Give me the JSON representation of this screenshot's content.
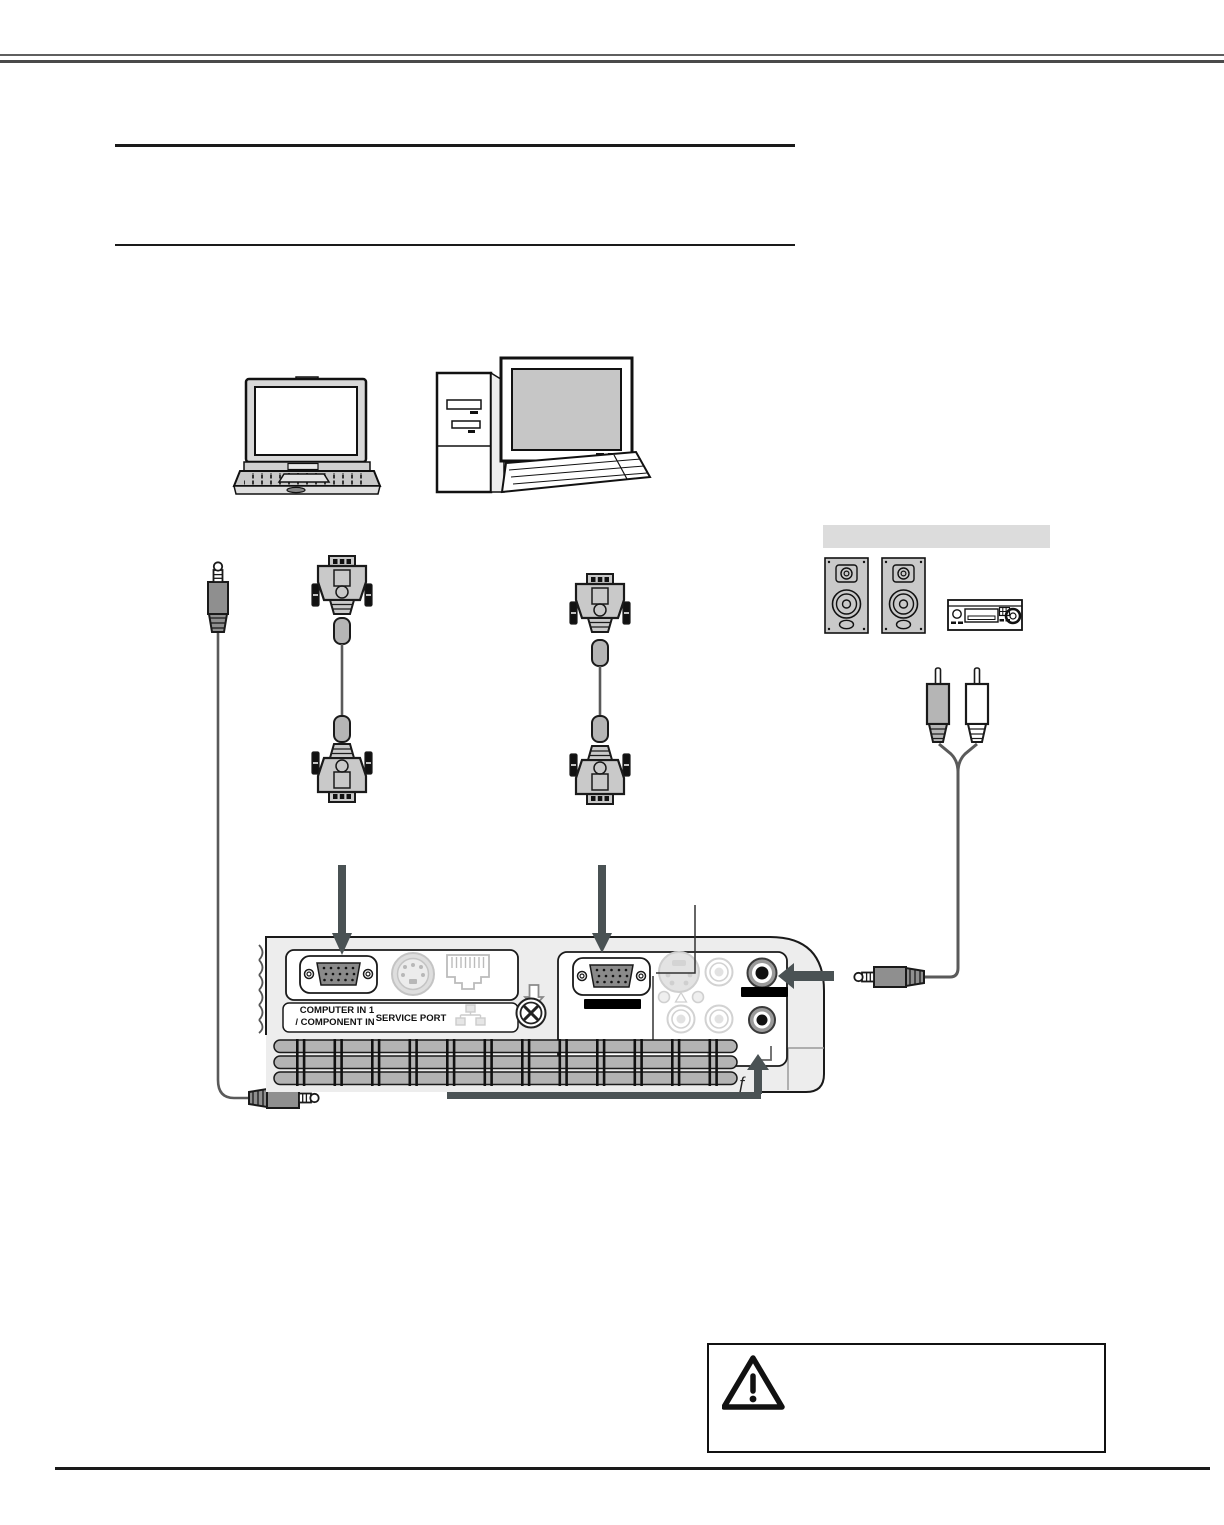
{
  "panel_labels": {
    "computer_in_line1": "COMPUTER IN 1",
    "computer_in_line2": "/ COMPONENT IN",
    "service_port": "SERVICE PORT",
    "stray_glyph": "ƒ"
  },
  "icons": {
    "warning": "warning-triangle-icon",
    "network": "lan-network-icon",
    "screw": "screw-icon",
    "down_arrow_glyph": "down-arrow-outline-icon"
  },
  "colors": {
    "connection_arrow": "#4a5254",
    "panel_body": "#ededed",
    "port_dark_gray": "#8a8a8a",
    "disabled_port": "#d6d6d6",
    "vent_bar": "#b3b3b3",
    "equipment_header_bar": "#dcdcdc",
    "rule_dark": "#1a1a1a",
    "rule_gray": "#5a5a5a",
    "cable_gray": "#5a5a5a"
  }
}
